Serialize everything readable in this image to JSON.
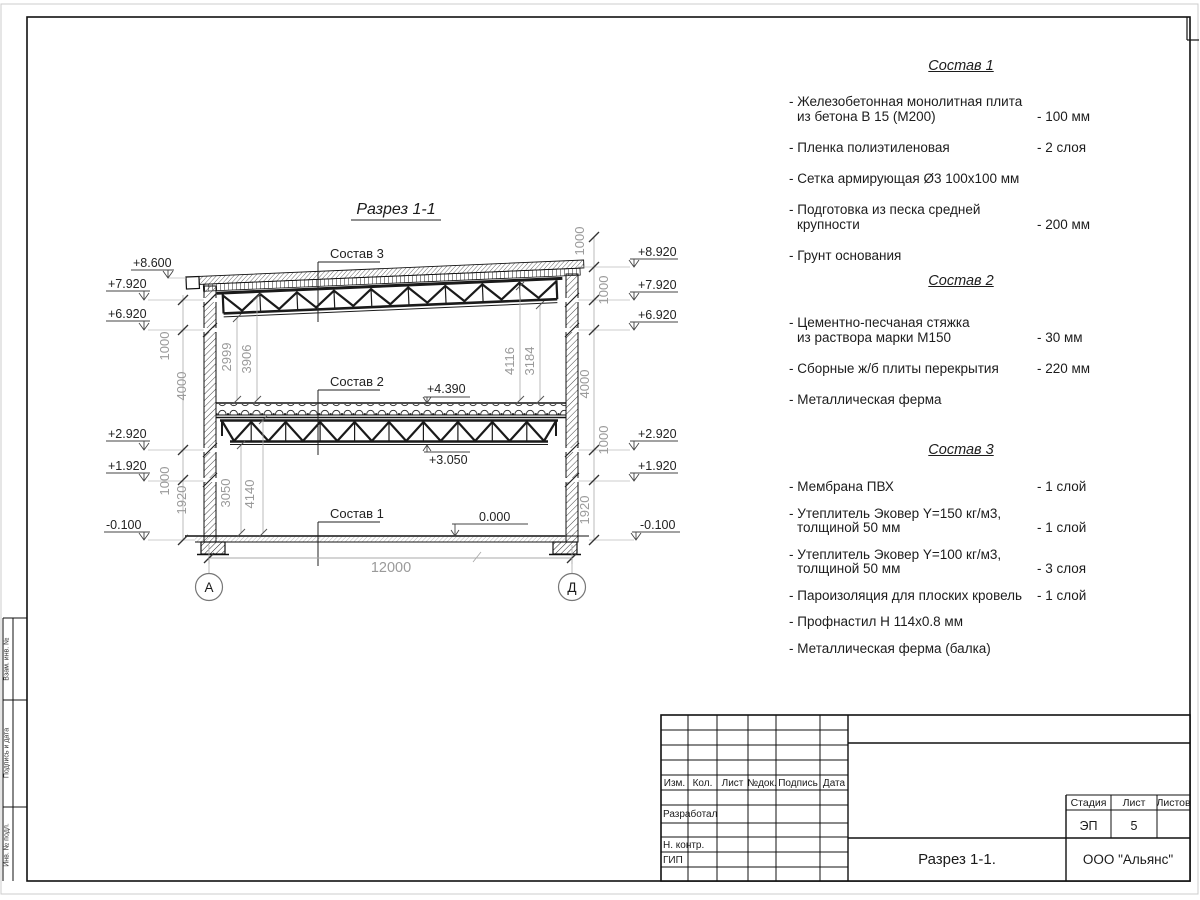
{
  "drawing": {
    "title": "Разрез 1-1",
    "labels": [
      "Состав 3",
      "Состав 2",
      "Состав 1"
    ],
    "marks": [
      "+4.390",
      "+3.050",
      "0.000"
    ],
    "elev_left": [
      "+8.600",
      "+7.920",
      "+6.920",
      "+2.920",
      "+1.920",
      "-0.100"
    ],
    "elev_right": [
      "+8.920",
      "+7.920",
      "+6.920",
      "+2.920",
      "+1.920",
      "-0.100"
    ],
    "dims_left": [
      "1000",
      "4000",
      "1000",
      "1920"
    ],
    "dims_right": [
      "1000",
      "1000",
      "4000",
      "1000",
      "1920"
    ],
    "dims_inner": [
      "2999",
      "3906",
      "4116",
      "3184",
      "3050",
      "4140"
    ],
    "span": "12000",
    "axes": [
      "А",
      "Д"
    ]
  },
  "sections": [
    {
      "title": "Состав 1",
      "items": [
        {
          "line1": "- Железобетонная  монолитная плита",
          "line2": "из бетона В 15 (М200)",
          "value": "- 100 мм"
        },
        {
          "line1": "- Пленка полиэтиленовая",
          "line2": "",
          "value": "-  2 слоя"
        },
        {
          "line1": "- Сетка армирующая Ø3 100х100 мм",
          "line2": "",
          "value": ""
        },
        {
          "line1": "- Подготовка из песка средней",
          "line2": "крупности",
          "value": "- 200 мм"
        },
        {
          "line1": "- Грунт основания",
          "line2": "",
          "value": ""
        }
      ]
    },
    {
      "title": "Состав 2",
      "items": [
        {
          "line1": "- Цементно-песчаная стяжка",
          "line2": "из раствора марки М150",
          "value": "- 30 мм"
        },
        {
          "line1": "- Сборные ж/б плиты перекрытия",
          "line2": "",
          "value": "- 220 мм"
        },
        {
          "line1": "- Металлическая ферма",
          "line2": "",
          "value": ""
        }
      ]
    },
    {
      "title": "Состав 3",
      "items": [
        {
          "line1": "- Мембрана ПВХ",
          "line2": "",
          "value": "- 1 слой"
        },
        {
          "line1": "- Утеплитель Эковер Y=150 кг/м3,",
          "line2": "толщиной 50 мм",
          "value": "- 1 слой"
        },
        {
          "line1": "- Утеплитель Эковер Y=100 кг/м3,",
          "line2": "толщиной 50 мм",
          "value": "- 3 слоя"
        },
        {
          "line1": "- Пароизоляция для плоских кровель",
          "line2": "",
          "value": "- 1 слой"
        },
        {
          "line1": "- Профнастил Н 114х0.8 мм",
          "line2": "",
          "value": ""
        },
        {
          "line1": "- Металлическая ферма (балка)",
          "line2": "",
          "value": ""
        }
      ]
    }
  ],
  "titleblock": {
    "cols": [
      "Изм.",
      "Кол.",
      "Лист",
      "№док.",
      "Подпись",
      "Дата"
    ],
    "rows": [
      "Разработал",
      "Н. контр.",
      "ГИП"
    ],
    "stage_label": "Стадия",
    "sheet_label": "Лист",
    "sheets_label": "Листов",
    "stage": "ЭП",
    "sheet": "5",
    "sheets": "",
    "doc_title": "Разрез  1-1.",
    "company": "ООО \"Альянс\""
  },
  "side_strip": [
    "Взам. инв. №",
    "Подпись и дата",
    "Инв. № подл."
  ]
}
